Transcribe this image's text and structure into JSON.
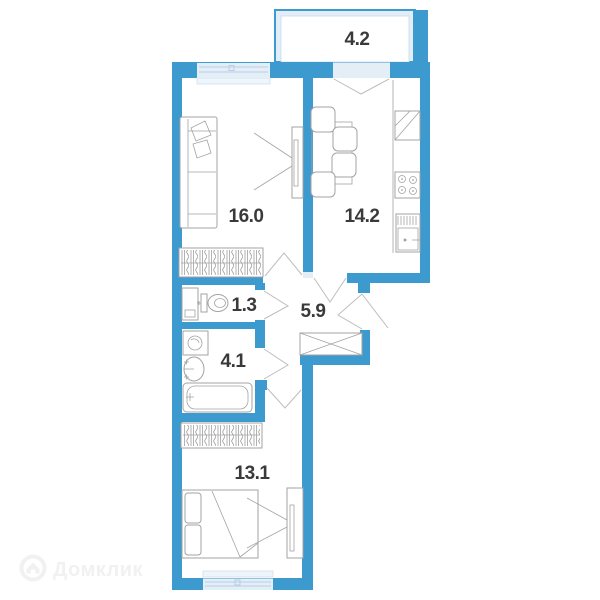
{
  "title": "Apartment floor plan",
  "colors": {
    "wall": "#3d9ace",
    "window": "#e4eef7",
    "sill": "#eef5fb",
    "furniture": "#a3a3a3",
    "door": "#bdbdbd",
    "text": "#3a3a3a",
    "watermark": "#f1f1f1"
  },
  "rooms": {
    "balcony": {
      "name": "balcony",
      "area": "4.2"
    },
    "living": {
      "name": "living room",
      "area": "16.0"
    },
    "kitchen": {
      "name": "kitchen",
      "area": "14.2"
    },
    "toilet": {
      "name": "toilet",
      "area": "1.3"
    },
    "hallway": {
      "name": "hallway",
      "area": "5.9"
    },
    "bathroom": {
      "name": "bathroom",
      "area": "4.1"
    },
    "bedroom": {
      "name": "bedroom",
      "area": "13.1"
    }
  },
  "watermark": {
    "brand": "Домклик",
    "logo_icon": "domclick-house-icon"
  }
}
